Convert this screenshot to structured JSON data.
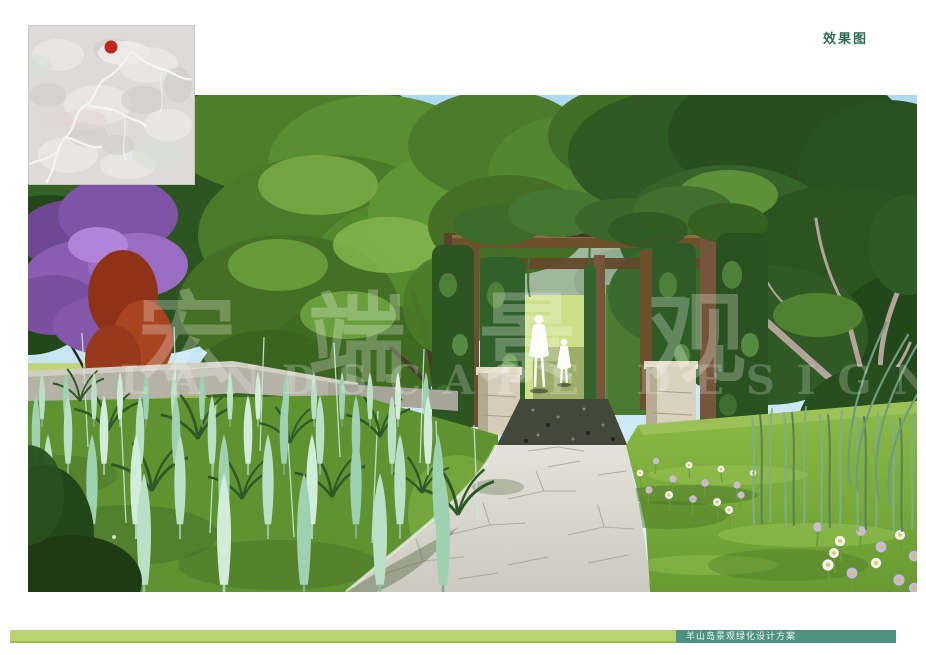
{
  "header": {
    "page_label": "效果图"
  },
  "footer": {
    "project_title": "羊山岛景观绿化设计方案"
  },
  "watermark": {
    "cjk_text": "宏端景观",
    "latin_text": "LANDSCAPE DESIGN"
  },
  "map_inset": {
    "marker": "red-dot",
    "marker_color": "#c0251e"
  },
  "colors": {
    "title_green": "#2f6b52",
    "footer_bar_light": "#b9d46e",
    "footer_bar_teal": "#4d9183",
    "sky_blue": "#aed9f1",
    "lawn_green": "#76ab38",
    "path_gray": "#d8d7d0",
    "pergola_wood": "#6e4f2e",
    "hedge_green": "#2c5522",
    "purple_bloom": "#8a5bad",
    "red_foliage": "#a93f1d",
    "reed_mint": "#b9e0c4",
    "flower_lavender": "#c7b8ea"
  }
}
